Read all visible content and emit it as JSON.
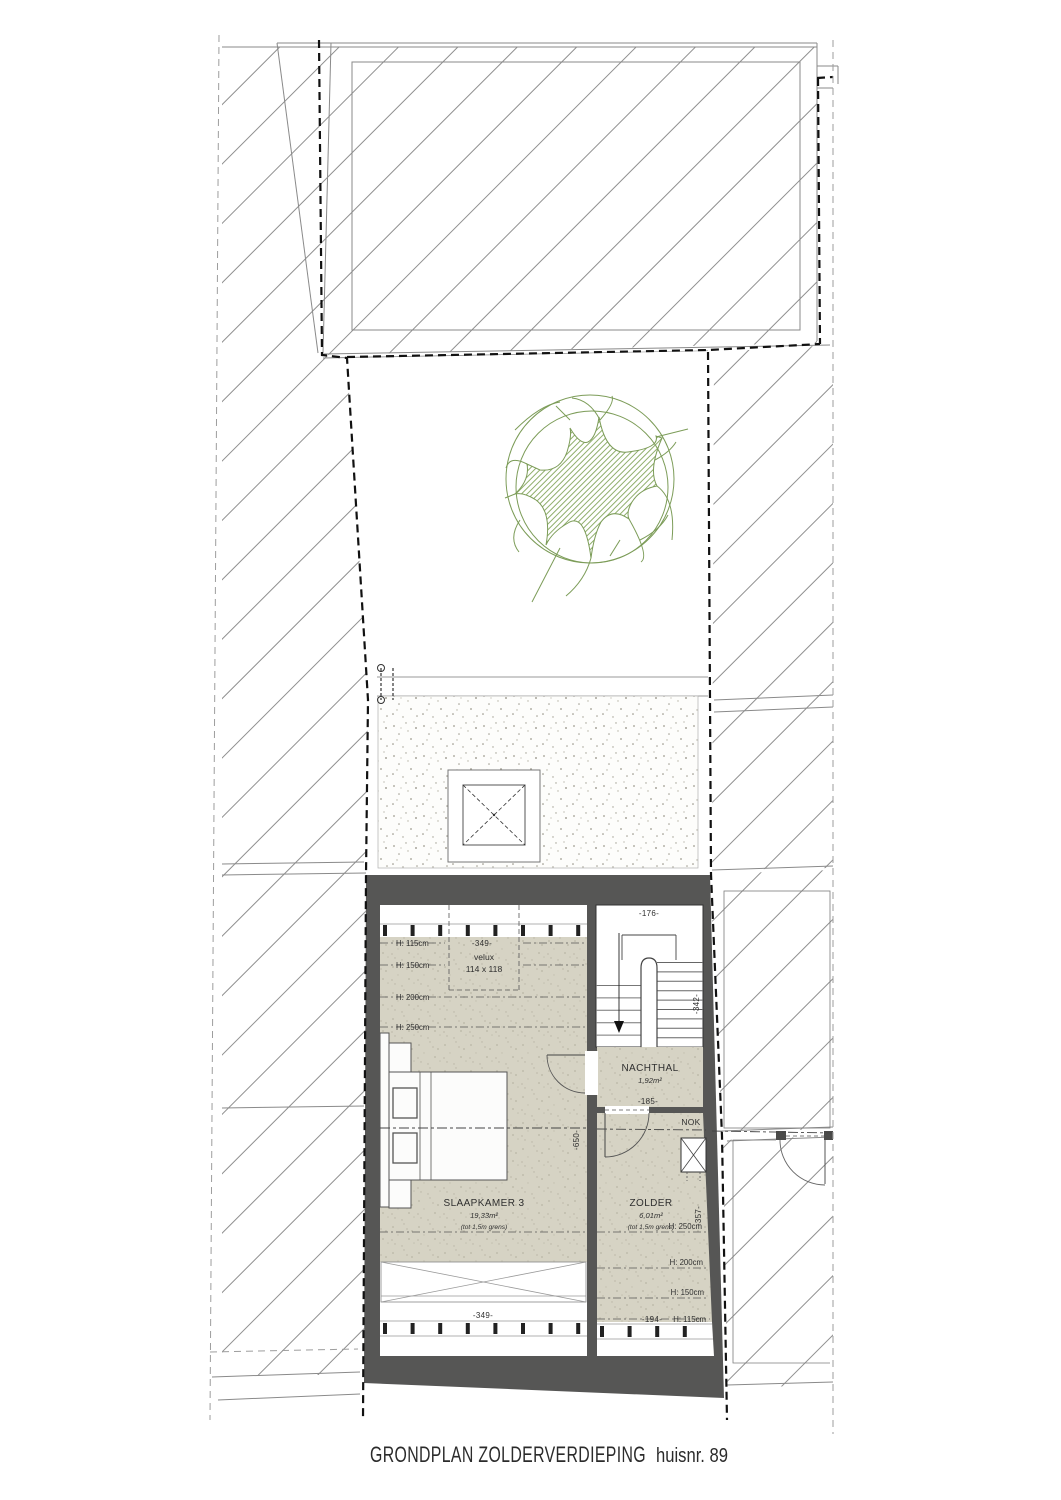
{
  "title": {
    "main": "GRONDPLAN ZOLDERVERDIEPING",
    "suffix": "huisnr. 89"
  },
  "rooms": {
    "slaapkamer": {
      "name": "SLAAPKAMER 3",
      "area": "19,33m²",
      "note": "(tot 1,5m grens)"
    },
    "zolder": {
      "name": "ZOLDER",
      "area": "6,01m²",
      "note": "(tot 1,5m grens)"
    },
    "nachthal": {
      "name": "NACHTHAL",
      "area": "1,92m²"
    }
  },
  "velux": {
    "label": "velux",
    "size": "114 x 118"
  },
  "ridge": {
    "label": "NOK"
  },
  "labels": {
    "h115": "H: 115cm",
    "h150": "H: 150cm",
    "h200": "H: 200cm",
    "h250": "H: 250cm"
  },
  "dims": {
    "width_top": "-349-",
    "stair_width": "-176-",
    "stair_depth": "-342-",
    "nachthal_width": "-185-",
    "slaapkamer_depth": "-650-",
    "zolder_depth": "-357-",
    "zolder_width": "-194-",
    "width_bottom": "-349-"
  },
  "colors": {
    "wall": "#565655",
    "floor": "#d6d3c4",
    "speckle": "#b9b6a6",
    "stipple_dot": "#a09d90",
    "hatch": "#8f8f8f",
    "tree": "#7c9c58",
    "ink": "#2f2f2f"
  }
}
